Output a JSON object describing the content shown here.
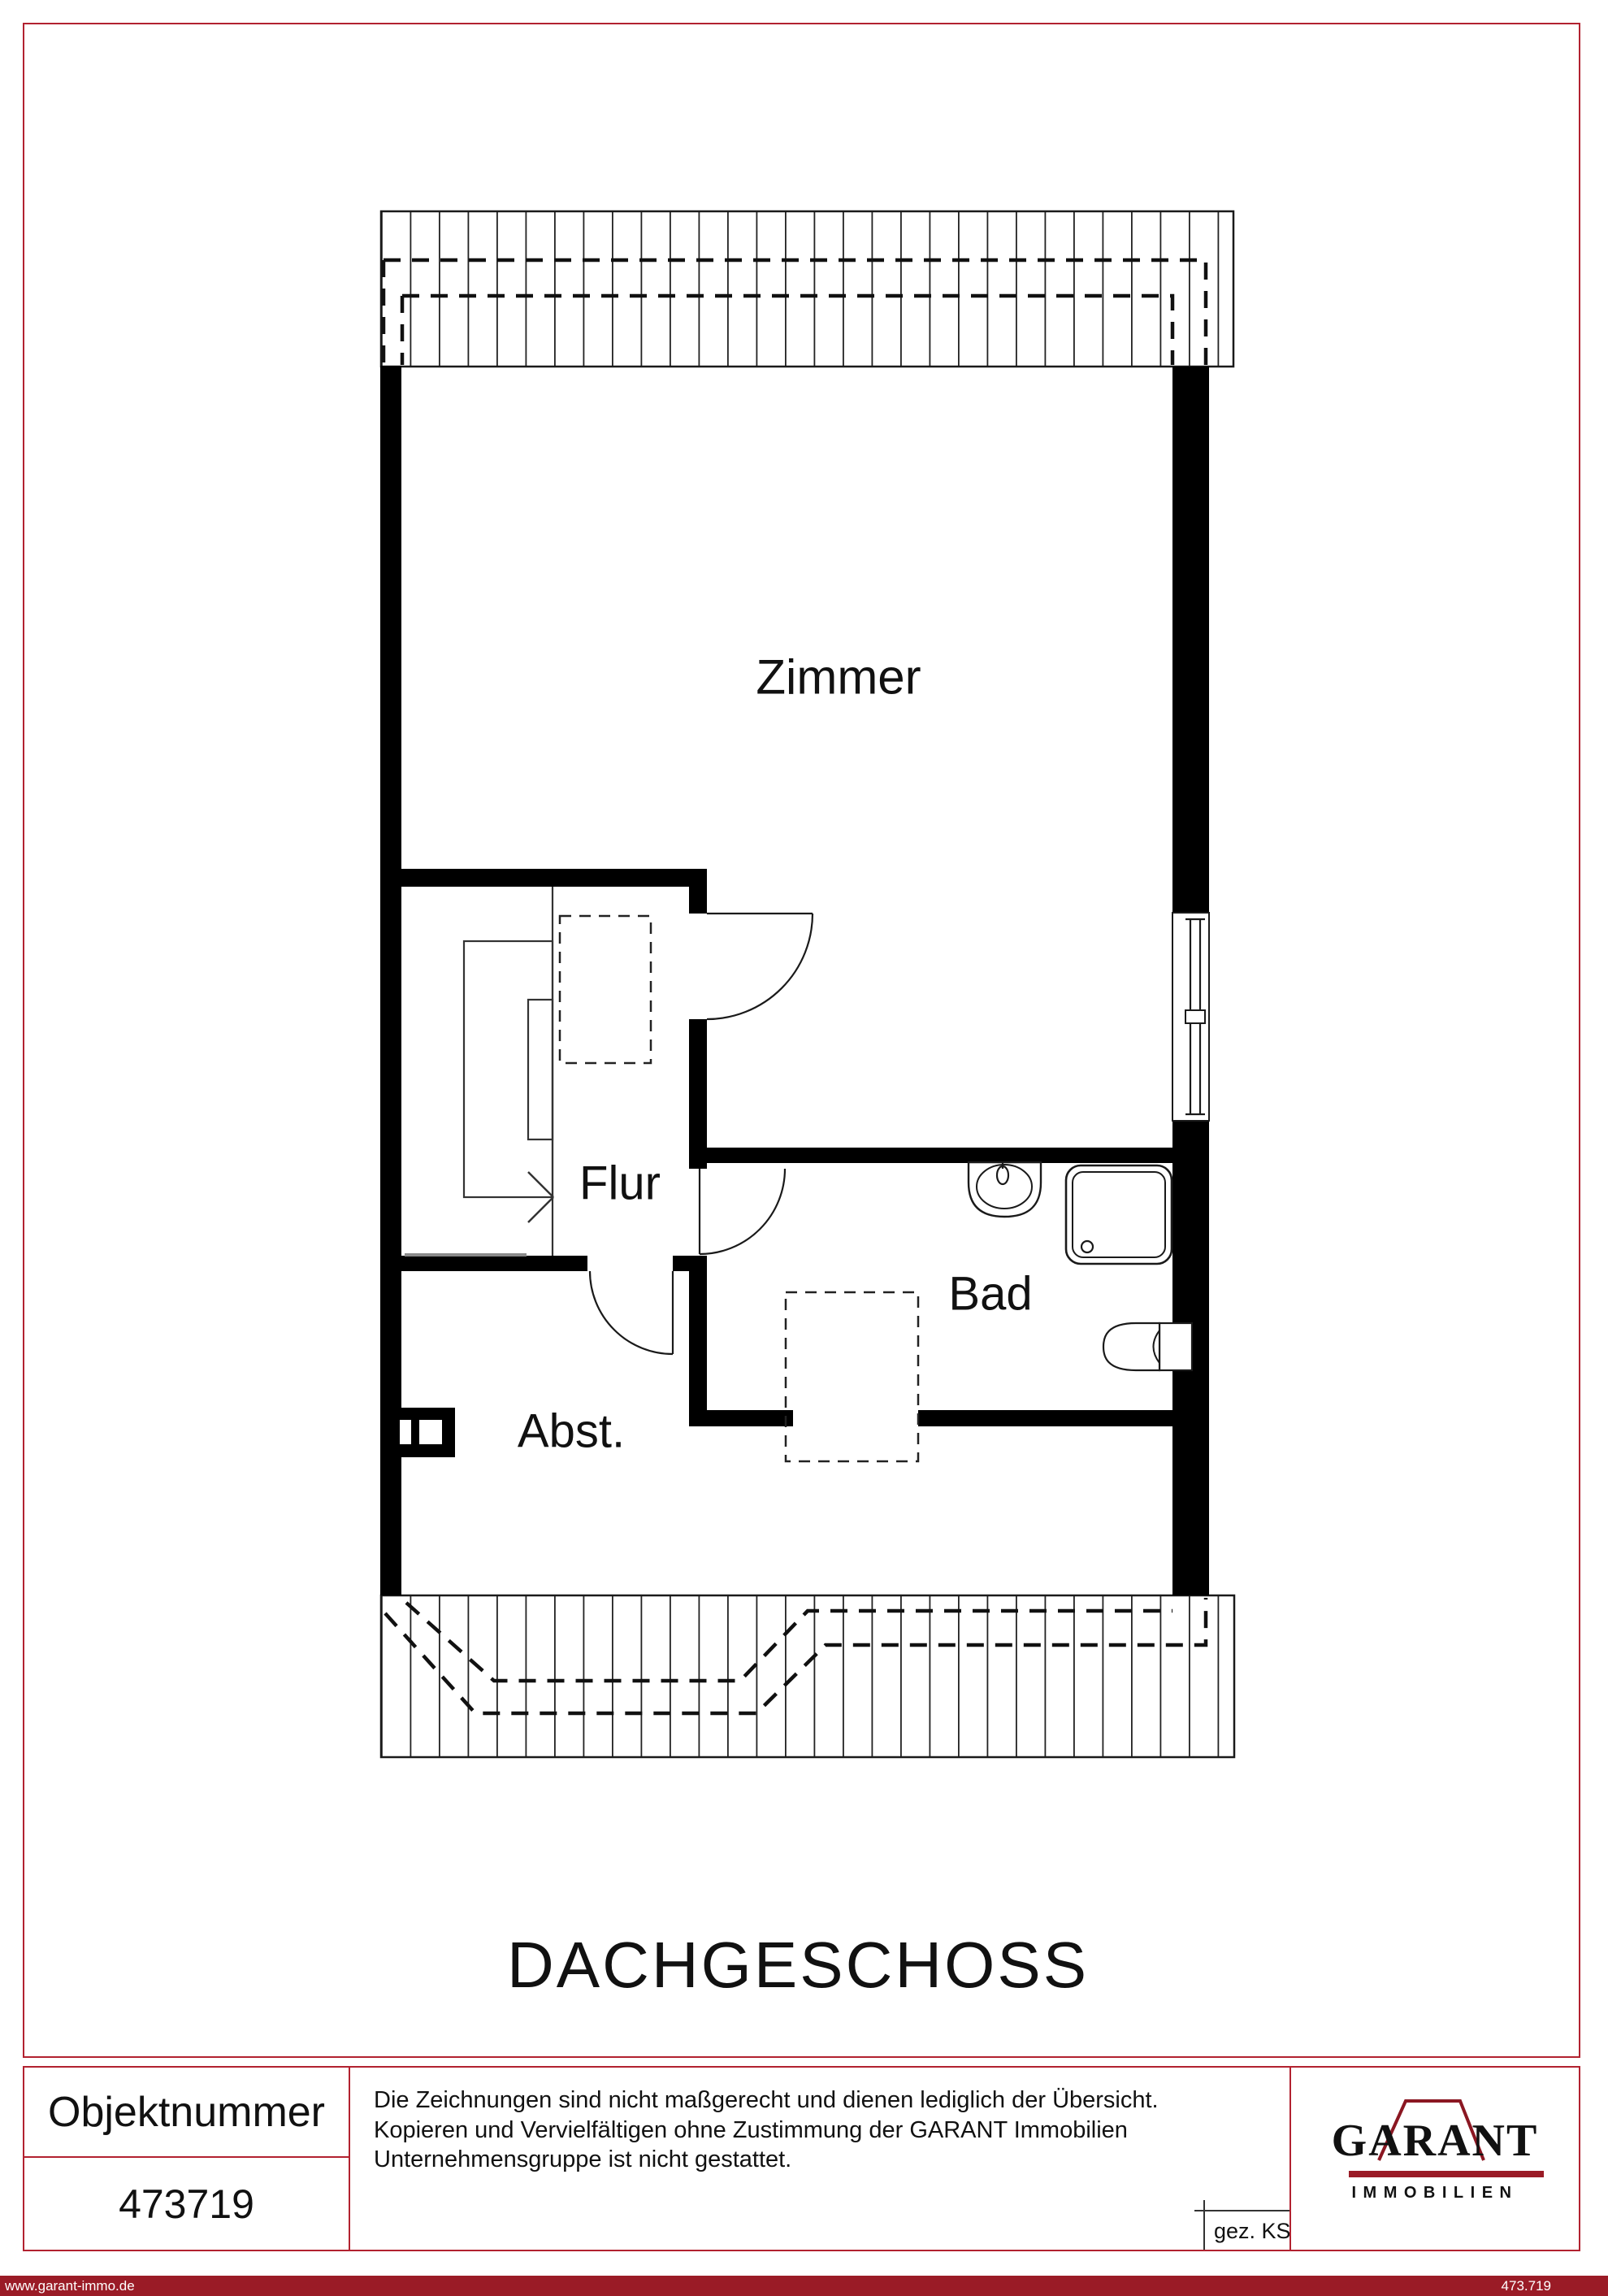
{
  "plan": {
    "title": "DACHGESCHOSS",
    "rooms": {
      "zimmer": "Zimmer",
      "flur": "Flur",
      "bad": "Bad",
      "abst": "Abst."
    }
  },
  "footer": {
    "object_number": {
      "label": "Objektnummer",
      "value": "473719"
    },
    "disclaimer": {
      "line1": "Die Zeichnungen sind nicht maßgerecht und dienen lediglich der Übersicht.",
      "line2": "Kopieren und Vervielfältigen ohne Zustimmung der GARANT Immobilien",
      "line3": "Unternehmensgruppe ist nicht gestattet."
    },
    "drawn_by": "gez. KS",
    "logo": {
      "brand": "GARANT",
      "subtitle": "IMMOBILIEN"
    }
  },
  "bottom_bar": {
    "website": "www.garant-immo.de",
    "reference": "473.719"
  },
  "colors": {
    "border_red": "#b22230",
    "bar_red": "#9a1b26",
    "logo_red": "#8b1722",
    "ink": "#1a1a1a"
  }
}
